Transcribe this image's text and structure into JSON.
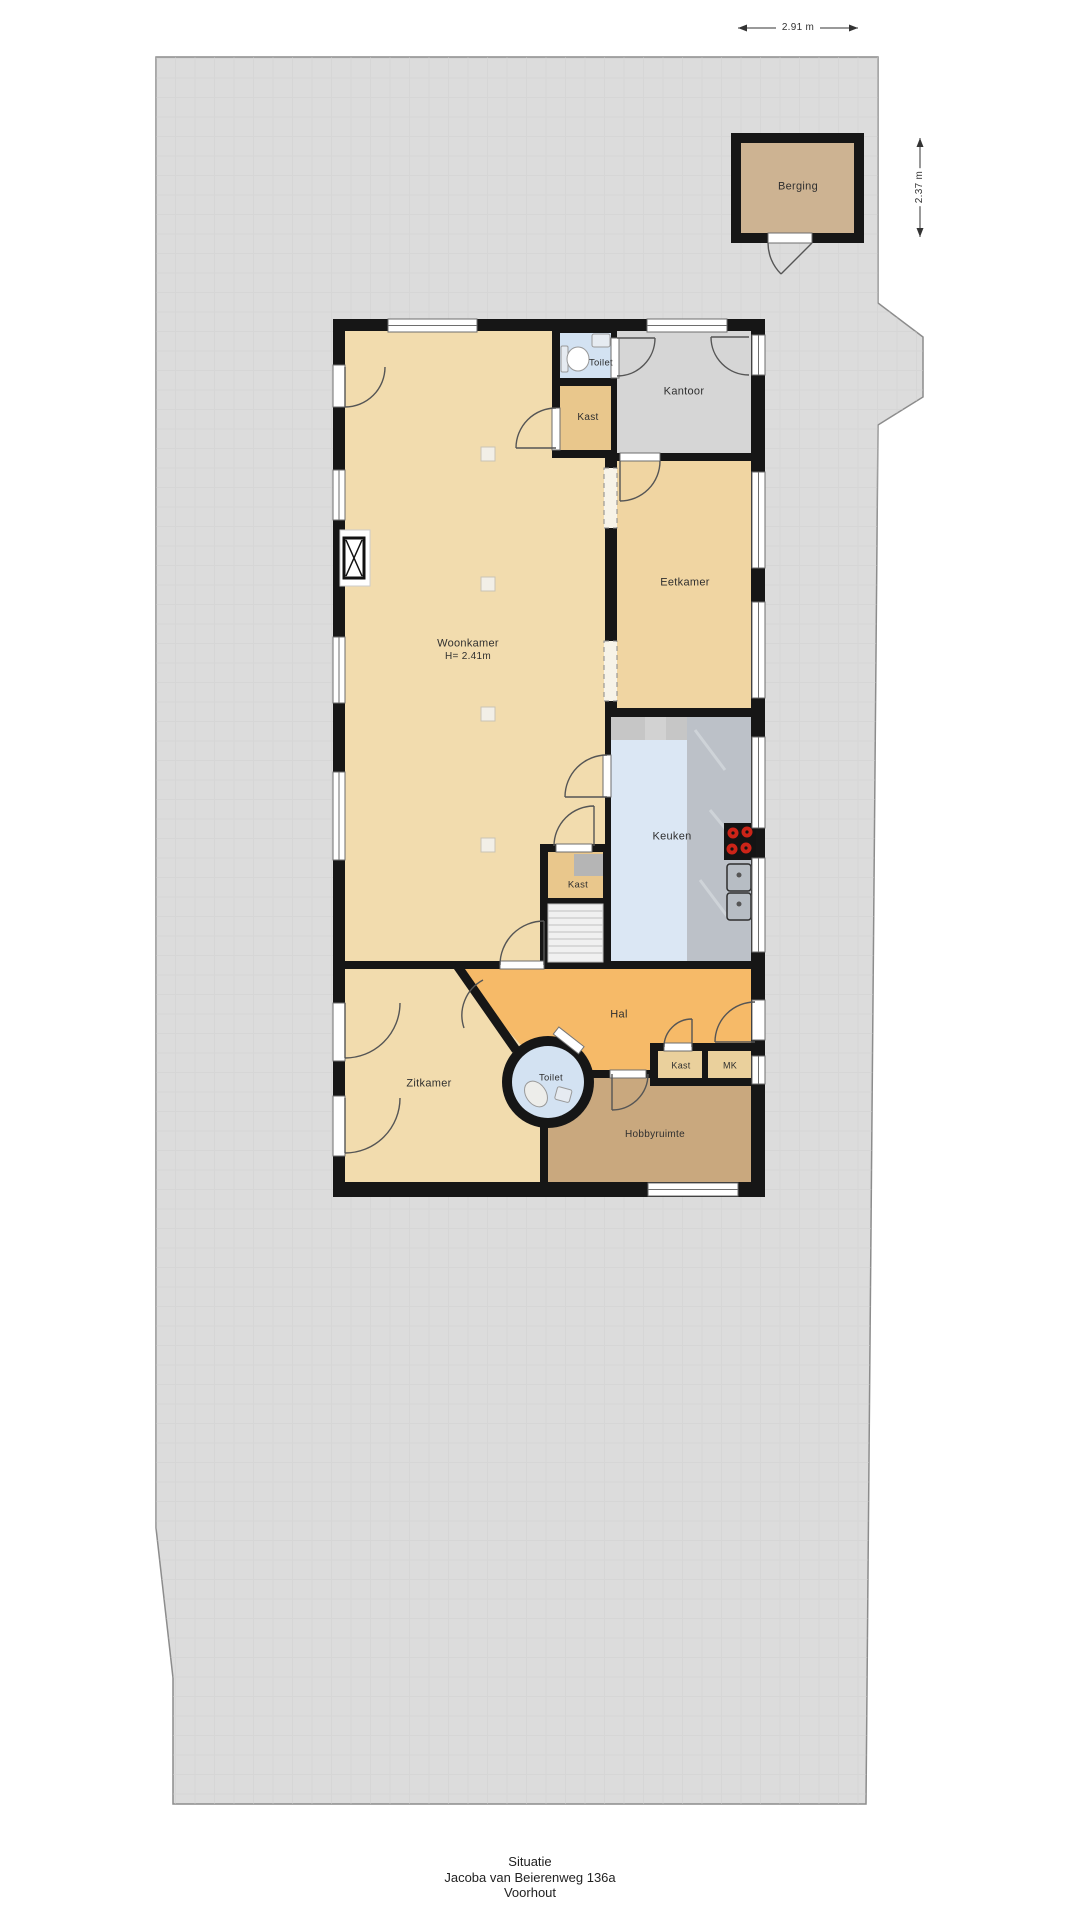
{
  "title": {
    "l1": "Situatie",
    "l2": "Jacoba van Beierenweg 136a",
    "l3": "Voorhout"
  },
  "dimensions": {
    "berging_width": "2.91 m",
    "berging_height": "2.37 m"
  },
  "rooms": {
    "berging": "Berging",
    "woonkamer": "Woonkamer",
    "woonkamer_height": "H= 2.41m",
    "toilet_top": "Toilet",
    "kast_top": "Kast",
    "kantoor": "Kantoor",
    "eetkamer": "Eetkamer",
    "keuken": "Keuken",
    "kast_mid": "Kast",
    "hal": "Hal",
    "zitkamer": "Zitkamer",
    "toilet_round": "Toilet",
    "kast_bottom": "Kast",
    "mk": "MK",
    "hobbyruimte": "Hobbyruimte"
  },
  "colors": {
    "terrain": "#dcdcdc",
    "terrain_line": "#d0d0d0",
    "terrain_border": "#8c8c8c",
    "wall": "#161616",
    "woonkamer": "#f2dcae",
    "eetkamer": "#f0d5a2",
    "zitkamer": "#f2dcae",
    "kantoor": "#d6d6d6",
    "toilet": "#d3e2f2",
    "keuken": "#dbe7f4",
    "kast": "#e9c78c",
    "kastklein": "#ead09c",
    "hal": "#f6ba68",
    "hobbyruimte": "#c9a87e",
    "berging": "#cdb392",
    "counter": "#c6c6c6",
    "counter_marble": "#bcc1c8",
    "stove": "#141414",
    "burner": "#cc2418",
    "stairs": "#f0f0f0",
    "window": "#ffffff",
    "window_frame": "#6e6e6e",
    "arc": "#555555",
    "fixture": "#e6ebf1",
    "label": "#2f2f2f",
    "dim": "#333333"
  }
}
